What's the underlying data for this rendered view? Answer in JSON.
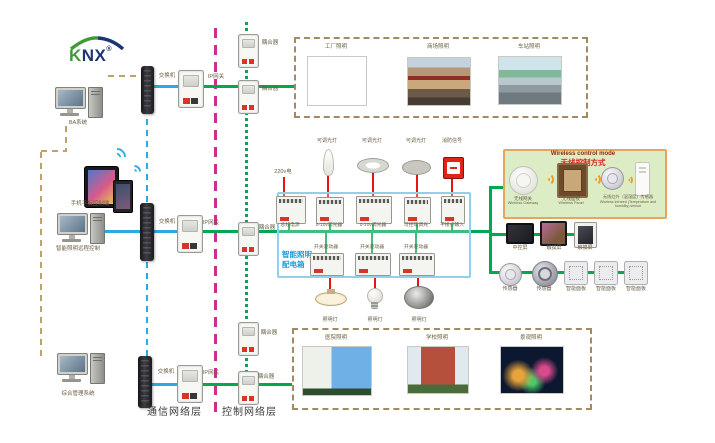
{
  "logo": {
    "k": "K",
    "nx": "NX",
    "reg": "®"
  },
  "left_column": {
    "computer_top_label": "BA系统",
    "mobile_label": "手机平板控制端",
    "computer_mid_label": "智能照明远程控制",
    "computer_bottom_label": "综合管理系统"
  },
  "network": {
    "switch": "交换机",
    "ip_gateway": "IP网关",
    "coupler": "耦合器"
  },
  "layer_labels": {
    "communication": "通信网络层",
    "control": "控制网络层"
  },
  "top_scenes": {
    "items": [
      {
        "label": "工厂照明"
      },
      {
        "label": "商场照明"
      },
      {
        "label": "车站照明"
      }
    ]
  },
  "bottom_scenes": {
    "items": [
      {
        "label": "医院照明"
      },
      {
        "label": "学校照明"
      },
      {
        "label": "景观照明"
      }
    ]
  },
  "distribution_panel": {
    "name_line1": "智能照明",
    "name_line2": "配电箱",
    "power_input": "220v电",
    "dimmable_lamp": "可调光灯",
    "fire_signal": "消防信号",
    "modules_top": [
      {
        "label": "总线电源"
      },
      {
        "label": "0-10v调光器"
      },
      {
        "label": "0-10v调光器"
      },
      {
        "label": "可控硅调光"
      },
      {
        "label": "干接点输入"
      }
    ],
    "modules_bottom": [
      {
        "label": "开关驱动器"
      },
      {
        "label": "开关驱动器"
      },
      {
        "label": "开关驱动器"
      }
    ],
    "lamp": "照明灯"
  },
  "wireless_box": {
    "title_en": "Wireless control mode",
    "title_zh": "无线控制方式",
    "devices": [
      {
        "zh": "无线网关",
        "en": "Wireless Gateway"
      },
      {
        "zh": "无线面板",
        "en": "Wireless Panel"
      },
      {
        "zh": "无线红外（温湿度）传感器",
        "en": "Wireless infrared (Temperature and humidity) sensor"
      }
    ]
  },
  "right_devices": {
    "screens": [
      {
        "label": "中控屏"
      },
      {
        "label": "触摸屏"
      },
      {
        "label": "触摸屏"
      }
    ],
    "panels": [
      {
        "label": "传感器"
      },
      {
        "label": "传感器"
      },
      {
        "label": "智能面板"
      },
      {
        "label": "智能面板"
      },
      {
        "label": "智能面板"
      }
    ]
  },
  "colors": {
    "knx_bus_green": "#00a84f",
    "ethernet_blue": "#2ea8e0",
    "mgmt_tan": "#bfa267",
    "layer_magenta": "#cc2d8f",
    "power_red": "#e81414",
    "panel_border_blue": "#93d0e8",
    "wireless_bg": "#dcedc6",
    "wireless_border": "#e8a45c"
  }
}
